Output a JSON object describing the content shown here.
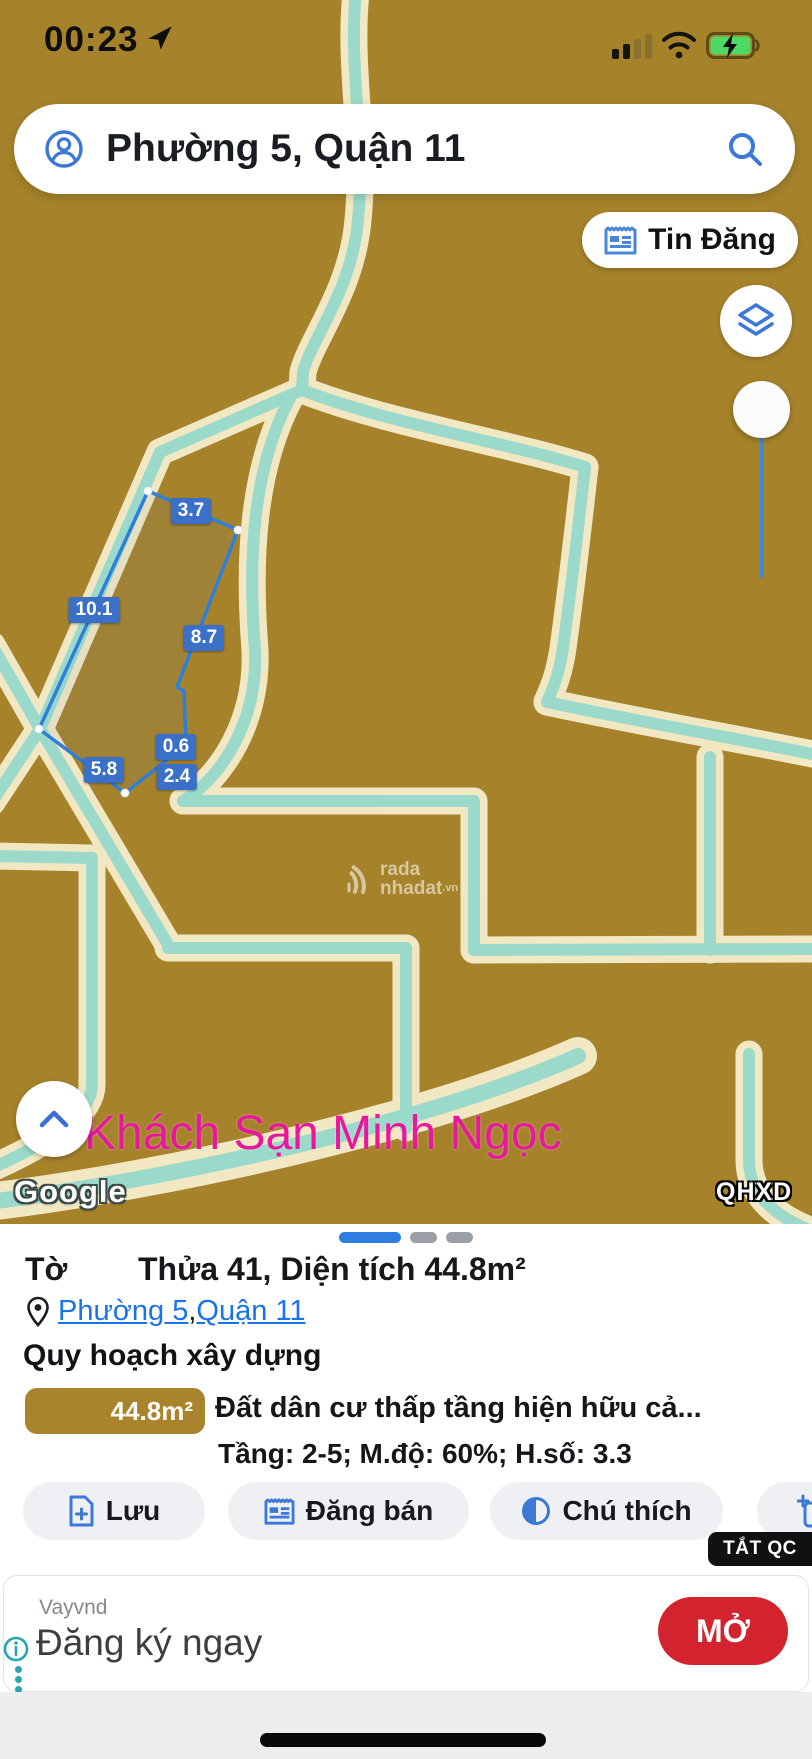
{
  "status_bar": {
    "time": "00:23"
  },
  "map": {
    "search_value": "Phường 5, Quận 11",
    "tin_dang_label": "Tin Đăng",
    "poi_label": "Khách Sạn Minh Ngọc",
    "google_label": "Google",
    "qhxd_label": "QHXD",
    "watermark": {
      "line1": "rada",
      "line2": "nhadat",
      "tld": ".vn"
    },
    "parcel": {
      "measurements": [
        "3.7",
        "10.1",
        "8.7",
        "0.6",
        "5.8",
        "2.4"
      ],
      "outline_color": "#2e7fd8",
      "label_bg": "#3a70c8"
    },
    "colors": {
      "ground": "#a6832b",
      "road": "#9bdaca",
      "road_halo": "#f6edcb"
    }
  },
  "panel": {
    "title_prefix": "Tờ",
    "title_main": "Thửa 41, Diện tích 44.8m²",
    "location": {
      "ward": "Phường 5",
      "comma": ", ",
      "district": "Quận 11"
    },
    "heading": "Quy hoạch xây dựng",
    "zoning": {
      "area": "44.8m²",
      "name": "Đất dân cư thấp tầng hiện hữu cả...",
      "detail": "Tầng: 2-5; M.độ: 60%; H.số: 3.3",
      "badge_color": "#a9842d"
    },
    "buttons": [
      {
        "label": "Lưu"
      },
      {
        "label": "Đăng bán"
      },
      {
        "label": "Chú thích"
      },
      {
        "label": ""
      }
    ],
    "link_color": "#1a73e8"
  },
  "ad": {
    "dismiss_label": "TẮT QC",
    "advertiser": "Vayvnd",
    "headline": "Đăng ký ngay",
    "cta_label": "MỞ",
    "cta_color": "#d2232e"
  }
}
